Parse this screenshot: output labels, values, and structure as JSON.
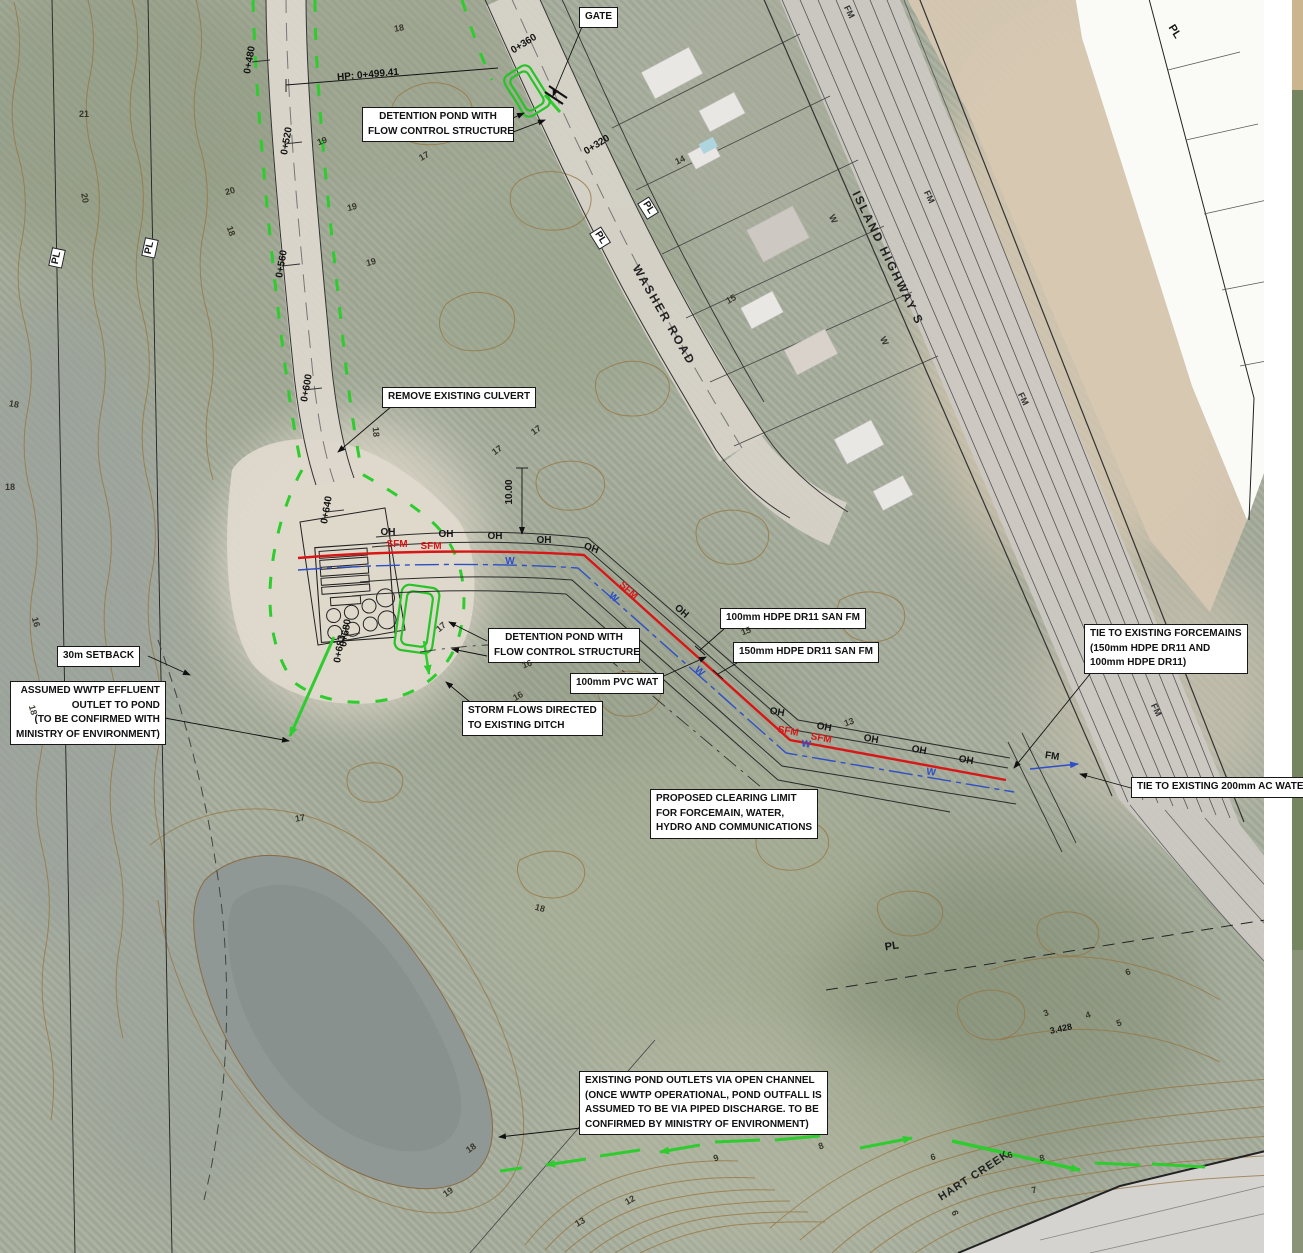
{
  "map": {
    "callouts": {
      "gate": "GATE",
      "detention_top_1": "DETENTION POND WITH",
      "detention_top_2": "FLOW CONTROL STRUCTURE",
      "remove_culvert": "REMOVE EXISTING CULVERT",
      "detention_mid_1": "DETENTION POND WITH",
      "detention_mid_2": "FLOW CONTROL STRUCTURE",
      "pvc_wat": "100mm PVC WAT",
      "storm_1": "STORM FLOWS DIRECTED",
      "storm_2": "TO EXISTING DITCH",
      "setback": "30m SETBACK",
      "wwtp_1": "ASSUMED WWTP EFFLUENT",
      "wwtp_2": "OUTLET TO POND",
      "wwtp_3": "(TO BE CONFIRMED WITH",
      "wwtp_4": "MINISTRY OF ENVIRONMENT)",
      "fm100": "100mm HDPE DR11 SAN FM",
      "fm150": "150mm HDPE DR11 SAN FM",
      "tie_fm_1": "TIE TO EXISTING FORCEMAINS",
      "tie_fm_2": "(150mm HDPE DR11 AND",
      "tie_fm_3": "100mm HDPE DR11)",
      "tie_water": "TIE TO EXISTING 200mm AC WATER",
      "clearing_1": "PROPOSED CLEARING LIMIT",
      "clearing_2": "FOR FORCEMAIN, WATER,",
      "clearing_3": "HYDRO AND COMMUNICATIONS",
      "pond_out_1": "EXISTING POND OUTLETS VIA OPEN CHANNEL",
      "pond_out_2": "(ONCE WWTP OPERATIONAL, POND OUTFALL IS",
      "pond_out_3": "ASSUMED TO BE VIA PIPED DISCHARGE. TO BE",
      "pond_out_4": "CONFIRMED BY MINISTRY OF ENVIRONMENT)"
    },
    "roads": {
      "washer": "WASHER ROAD",
      "island": "ISLAND HIGHWAY S",
      "creek": "HART CREEK"
    },
    "stations": [
      {
        "t": "0+480"
      },
      {
        "t": "HP: 0+499.41"
      },
      {
        "t": "0+520"
      },
      {
        "t": "0+560"
      },
      {
        "t": "0+600"
      },
      {
        "t": "0+640"
      },
      {
        "t": "0+680"
      },
      {
        "t": "0+683"
      },
      {
        "t": "0+360"
      },
      {
        "t": "0+320"
      }
    ],
    "pl": "PL",
    "oh": "OH",
    "w": "W",
    "fm": "FM",
    "sfm": "SFM",
    "dimension": "10.00",
    "spot_elev": "3.428",
    "contours": [
      {
        "t": "21"
      },
      {
        "t": "20"
      },
      {
        "t": "20"
      },
      {
        "t": "18"
      },
      {
        "t": "19"
      },
      {
        "t": "17"
      },
      {
        "t": "19"
      },
      {
        "t": "19"
      },
      {
        "t": "18"
      },
      {
        "t": "18"
      },
      {
        "t": "18"
      },
      {
        "t": "17"
      },
      {
        "t": "17"
      },
      {
        "t": "18"
      },
      {
        "t": "14"
      },
      {
        "t": "15"
      },
      {
        "t": "15"
      },
      {
        "t": "16"
      },
      {
        "t": "17"
      },
      {
        "t": "16"
      },
      {
        "t": "13"
      },
      {
        "t": "17"
      },
      {
        "t": "18"
      },
      {
        "t": "18"
      },
      {
        "t": "19"
      },
      {
        "t": "12"
      },
      {
        "t": "13"
      },
      {
        "t": "9"
      },
      {
        "t": "8"
      },
      {
        "t": "6"
      },
      {
        "t": "6"
      },
      {
        "t": "8"
      },
      {
        "t": "7"
      },
      {
        "t": "6"
      },
      {
        "t": "6"
      },
      {
        "t": "3"
      },
      {
        "t": "4"
      },
      {
        "t": "5"
      },
      {
        "t": "16"
      },
      {
        "t": "18"
      }
    ],
    "colors": {
      "clearing_green": "#2ecc2e",
      "forcemain_red": "#d81616",
      "water_blue": "#2e4fc5",
      "contour_brown": "#96743f"
    }
  }
}
